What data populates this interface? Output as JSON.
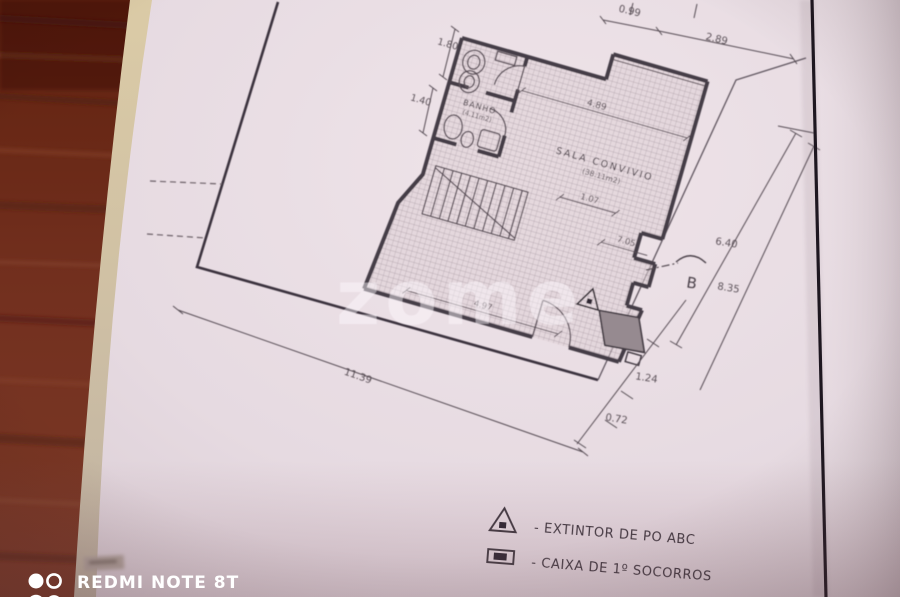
{
  "photo": {
    "camera_watermark": {
      "line1": "REDMI NOTE 8T",
      "line2": "AI QUAD CAMERA"
    },
    "agency_watermark": "zome"
  },
  "plan": {
    "rooms": {
      "sala": {
        "name": "SALA CONVIVIO",
        "area": "(38.11m2)"
      },
      "banho": {
        "name": "BANHO",
        "area": "(4.11m2)"
      }
    },
    "dimensions": {
      "d180": "1.80",
      "d140": "1.40",
      "d099": "0.99",
      "d289": "2.89",
      "d489": "4.89",
      "d107": "1.07",
      "d705": "7.05",
      "d497": "4.97",
      "d1139": "11.39",
      "d640": "6.40",
      "d835": "8.35",
      "d124": "1.24",
      "d072": "0.72"
    },
    "section_marker": "B",
    "legend": {
      "extintor": {
        "icon": "triangle-dot",
        "label": "- EXTINTOR DE PO ABC"
      },
      "socorros": {
        "icon": "box-dot",
        "label": "- CAIXA DE 1º SOCORROS"
      }
    },
    "colors": {
      "wood": "#6e2a1d",
      "paper": "#e7dce2",
      "ink": "#4a4148",
      "watermark": "#ffffff"
    }
  }
}
